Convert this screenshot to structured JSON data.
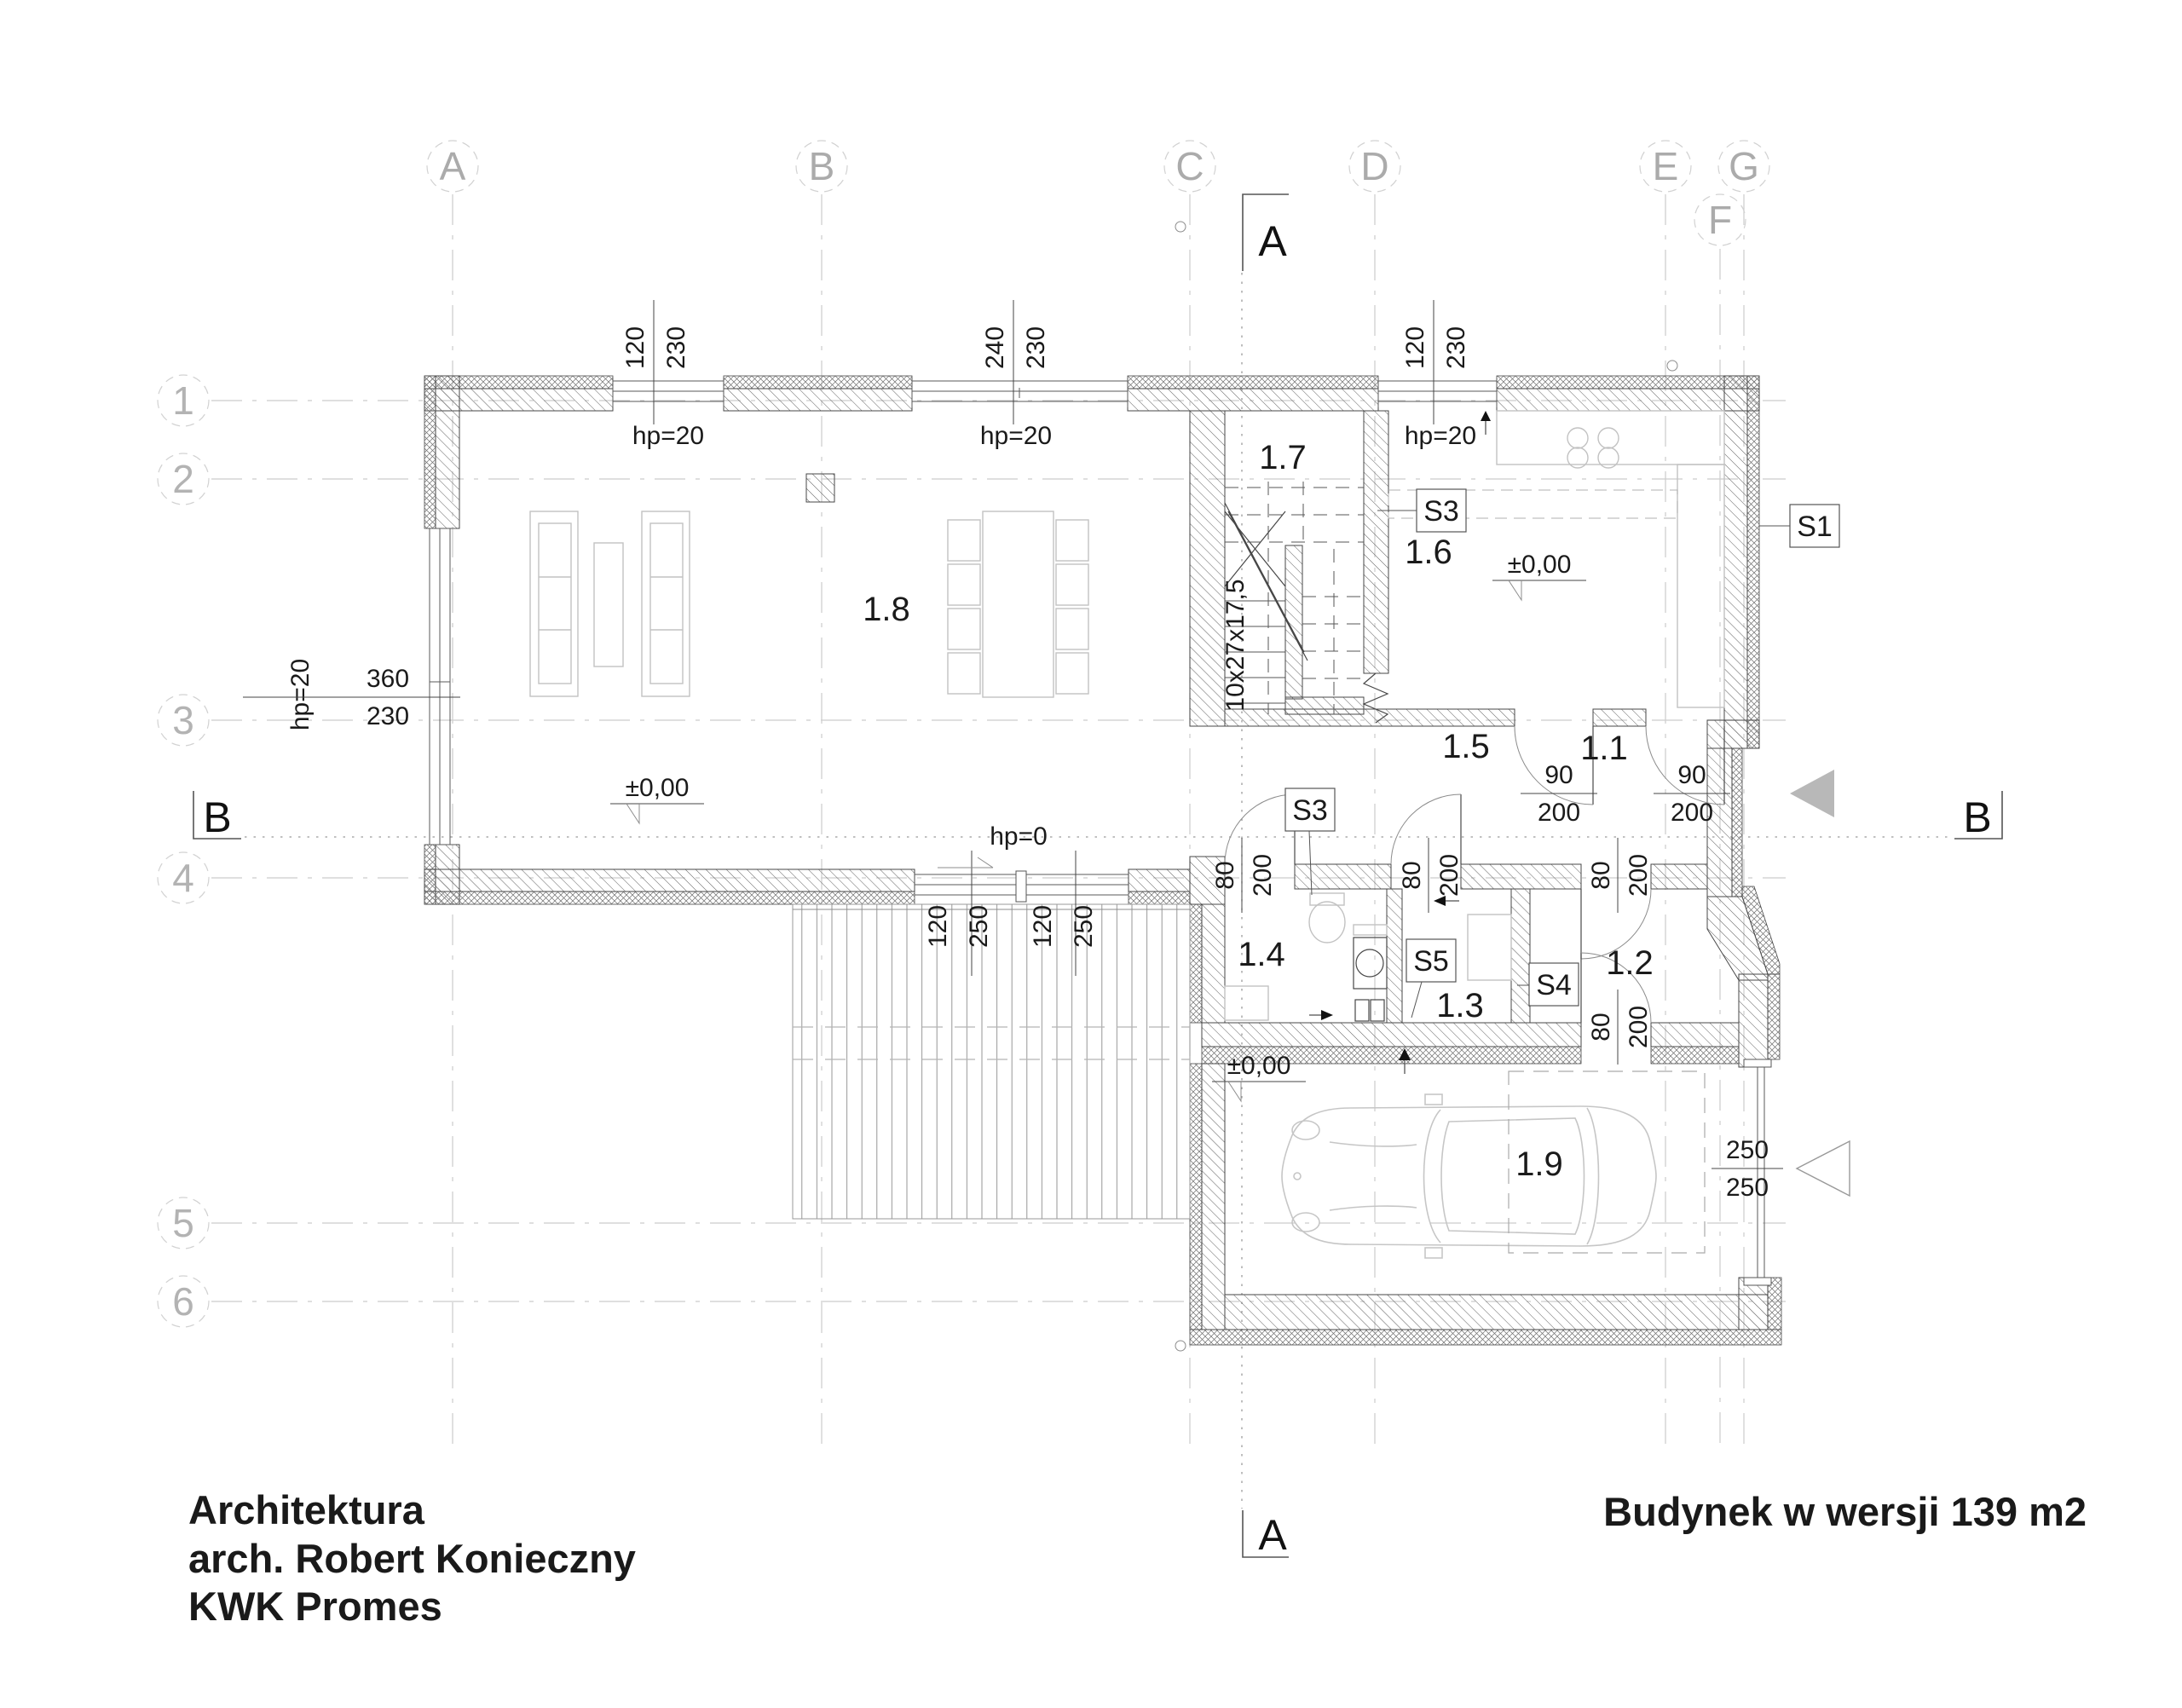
{
  "title_block": {
    "studio": "Architektura",
    "architect": "arch. Robert Konieczny",
    "office": "KWK Promes",
    "project": "Budynek w wersji 139 m2"
  },
  "grid": {
    "cols": [
      "A",
      "B",
      "C",
      "D",
      "E",
      "F",
      "G"
    ],
    "rows": [
      "1",
      "2",
      "3",
      "4",
      "5",
      "6"
    ]
  },
  "sections": {
    "a": "A",
    "b": "B"
  },
  "rooms": {
    "r11": "1.1",
    "r12": "1.2",
    "r13": "1.3",
    "r14": "1.4",
    "r15": "1.5",
    "r16": "1.6",
    "r17": "1.7",
    "r18": "1.8",
    "r19": "1.9"
  },
  "markers": {
    "s1": "S1",
    "s3": "S3",
    "s4": "S4",
    "s5": "S5"
  },
  "levels": {
    "zero": "±0,00"
  },
  "stair": {
    "spec": "10x27x17,5"
  },
  "annotations": {
    "hp20": "hp=20",
    "hp0": "hp=0"
  },
  "dimensions": {
    "win120_230": {
      "w": "120",
      "h": "230"
    },
    "win240_230": {
      "w": "240",
      "h": "230"
    },
    "win360_230": {
      "w": "360",
      "h": "230"
    },
    "door90_200": {
      "w": "90",
      "h": "200"
    },
    "door80_200": {
      "w": "80",
      "h": "200"
    },
    "door120_250": {
      "w": "120",
      "h": "250"
    },
    "garage250_250": {
      "w": "250",
      "h": "250"
    }
  }
}
